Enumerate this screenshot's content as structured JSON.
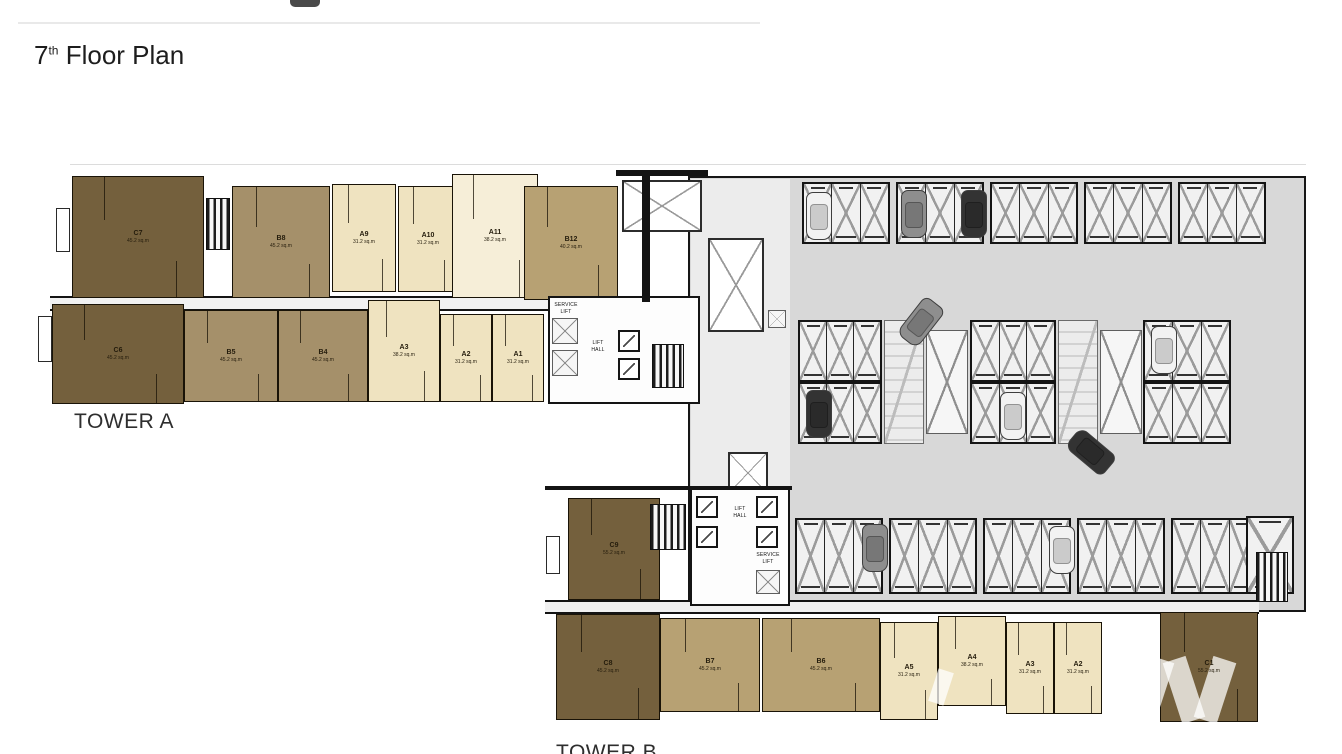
{
  "title": {
    "number": "7",
    "ordinal": "th",
    "rest": " Floor Plan"
  },
  "tower_a_label": "TOWER A",
  "tower_b_label": "TOWER B",
  "core_labels": {
    "lift_hall": "LIFT\nHALL",
    "service_lift": "SERVICE\nLIFT"
  },
  "palette": {
    "unit_dark": "#74603d",
    "unit_medium": "#a5906a",
    "unit_tan": "#b7a173",
    "unit_cream": "#efe3c0",
    "unit_cream_light": "#f6eed8",
    "parking_floor": "#d8d8d8",
    "connector_floor": "#ececec",
    "wall": "#141414",
    "stall_line": "#9b9b9b",
    "car_white": "#f2f2f2",
    "car_gray": "#8e8e8e",
    "car_dark": "#333333"
  },
  "plan": {
    "floors": [
      {
        "x": 688,
        "y": 176,
        "w": 618,
        "h": 436,
        "color": "parking_floor",
        "border": true
      },
      {
        "x": 691,
        "y": 179,
        "w": 99,
        "h": 429,
        "color": "connector_floor",
        "border": false
      }
    ],
    "corridors": [
      {
        "x": 50,
        "y": 296,
        "w": 650,
        "h": 15
      },
      {
        "x": 545,
        "y": 600,
        "w": 714,
        "h": 14
      }
    ],
    "units": [
      {
        "tower": "A",
        "id": "C7",
        "area": "45.2 sq.m",
        "palette": "unit_dark",
        "x": 72,
        "y": 176,
        "w": 132,
        "h": 122
      },
      {
        "tower": "A",
        "id": "B8",
        "area": "45.2 sq.m",
        "palette": "unit_medium",
        "x": 232,
        "y": 186,
        "w": 98,
        "h": 112
      },
      {
        "tower": "A",
        "id": "A9",
        "area": "31.2 sq.m",
        "palette": "unit_cream",
        "x": 332,
        "y": 184,
        "w": 64,
        "h": 108
      },
      {
        "tower": "A",
        "id": "A10",
        "area": "31.2 sq.m",
        "palette": "unit_cream",
        "x": 398,
        "y": 186,
        "w": 60,
        "h": 106
      },
      {
        "tower": "A",
        "id": "A11",
        "area": "38.2 sq.m",
        "palette": "unit_cream_light",
        "x": 452,
        "y": 174,
        "w": 86,
        "h": 124
      },
      {
        "tower": "A",
        "id": "B12",
        "area": "40.2 sq.m",
        "palette": "unit_tan",
        "x": 524,
        "y": 186,
        "w": 94,
        "h": 114
      },
      {
        "tower": "A",
        "id": "C6",
        "area": "45.2 sq.m",
        "palette": "unit_dark",
        "x": 52,
        "y": 304,
        "w": 132,
        "h": 100
      },
      {
        "tower": "A",
        "id": "B5",
        "area": "45.2 sq.m",
        "palette": "unit_medium",
        "x": 184,
        "y": 310,
        "w": 94,
        "h": 92
      },
      {
        "tower": "A",
        "id": "B4",
        "area": "45.2 sq.m",
        "palette": "unit_medium",
        "x": 278,
        "y": 310,
        "w": 90,
        "h": 92
      },
      {
        "tower": "A",
        "id": "A3",
        "area": "38.2 sq.m",
        "palette": "unit_cream",
        "x": 368,
        "y": 300,
        "w": 72,
        "h": 102
      },
      {
        "tower": "A",
        "id": "A2",
        "area": "31.2 sq.m",
        "palette": "unit_cream",
        "x": 440,
        "y": 314,
        "w": 52,
        "h": 88
      },
      {
        "tower": "A",
        "id": "A1",
        "area": "31.2 sq.m",
        "palette": "unit_cream",
        "x": 492,
        "y": 314,
        "w": 52,
        "h": 88
      },
      {
        "tower": "B",
        "id": "C9",
        "area": "55.2 sq.m",
        "palette": "unit_dark",
        "x": 568,
        "y": 498,
        "w": 92,
        "h": 102
      },
      {
        "tower": "B",
        "id": "C8",
        "area": "45.2 sq.m",
        "palette": "unit_dark",
        "x": 556,
        "y": 614,
        "w": 104,
        "h": 106
      },
      {
        "tower": "B",
        "id": "B7",
        "area": "45.2 sq.m",
        "palette": "unit_tan",
        "x": 660,
        "y": 618,
        "w": 100,
        "h": 94
      },
      {
        "tower": "B",
        "id": "B6",
        "area": "45.2 sq.m",
        "palette": "unit_tan",
        "x": 762,
        "y": 618,
        "w": 118,
        "h": 94
      },
      {
        "tower": "B",
        "id": "A5",
        "area": "31.2 sq.m",
        "palette": "unit_cream",
        "x": 880,
        "y": 622,
        "w": 58,
        "h": 98
      },
      {
        "tower": "B",
        "id": "A4",
        "area": "38.2 sq.m",
        "palette": "unit_cream",
        "x": 938,
        "y": 616,
        "w": 68,
        "h": 90
      },
      {
        "tower": "B",
        "id": "A3",
        "area": "31.2 sq.m",
        "palette": "unit_cream",
        "x": 1006,
        "y": 622,
        "w": 48,
        "h": 92
      },
      {
        "tower": "B",
        "id": "A2",
        "area": "31.2 sq.m",
        "palette": "unit_cream",
        "x": 1054,
        "y": 622,
        "w": 48,
        "h": 92
      },
      {
        "tower": "B",
        "id": "C1",
        "area": "55.2 sq.m",
        "palette": "unit_dark",
        "x": 1160,
        "y": 612,
        "w": 98,
        "h": 110
      }
    ],
    "stall_groups": [
      {
        "x": 802,
        "y": 182,
        "w": 88,
        "h": 62,
        "n": 3
      },
      {
        "x": 896,
        "y": 182,
        "w": 88,
        "h": 62,
        "n": 3
      },
      {
        "x": 990,
        "y": 182,
        "w": 88,
        "h": 62,
        "n": 3
      },
      {
        "x": 1084,
        "y": 182,
        "w": 88,
        "h": 62,
        "n": 3
      },
      {
        "x": 1178,
        "y": 182,
        "w": 88,
        "h": 62,
        "n": 3
      },
      {
        "x": 798,
        "y": 320,
        "w": 84,
        "h": 62,
        "n": 3
      },
      {
        "x": 970,
        "y": 320,
        "w": 86,
        "h": 62,
        "n": 3
      },
      {
        "x": 1143,
        "y": 320,
        "w": 88,
        "h": 62,
        "n": 3
      },
      {
        "x": 798,
        "y": 382,
        "w": 84,
        "h": 62,
        "n": 3
      },
      {
        "x": 970,
        "y": 382,
        "w": 86,
        "h": 62,
        "n": 3
      },
      {
        "x": 1143,
        "y": 382,
        "w": 88,
        "h": 62,
        "n": 3
      },
      {
        "x": 795,
        "y": 518,
        "w": 88,
        "h": 76,
        "n": 3
      },
      {
        "x": 889,
        "y": 518,
        "w": 88,
        "h": 76,
        "n": 3
      },
      {
        "x": 983,
        "y": 518,
        "w": 88,
        "h": 76,
        "n": 3
      },
      {
        "x": 1077,
        "y": 518,
        "w": 88,
        "h": 76,
        "n": 3
      },
      {
        "x": 1171,
        "y": 518,
        "w": 88,
        "h": 76,
        "n": 3
      },
      {
        "x": 1246,
        "y": 516,
        "w": 48,
        "h": 78,
        "n": 1
      }
    ],
    "ramps": [
      {
        "x": 884,
        "y": 320,
        "w": 40,
        "h": 124
      },
      {
        "x": 1058,
        "y": 320,
        "w": 40,
        "h": 124
      }
    ],
    "xboxes": [
      {
        "x": 926,
        "y": 330,
        "w": 42,
        "h": 104
      },
      {
        "x": 1100,
        "y": 330,
        "w": 42,
        "h": 104
      }
    ],
    "voids": [
      {
        "x": 622,
        "y": 180,
        "w": 80,
        "h": 52
      },
      {
        "x": 708,
        "y": 238,
        "w": 56,
        "h": 94
      },
      {
        "x": 728,
        "y": 452,
        "w": 40,
        "h": 42
      }
    ],
    "shafts": [
      {
        "x": 552,
        "y": 318,
        "w": 26,
        "h": 26
      },
      {
        "x": 552,
        "y": 350,
        "w": 26,
        "h": 26
      },
      {
        "x": 756,
        "y": 570,
        "w": 24,
        "h": 24
      },
      {
        "x": 768,
        "y": 310,
        "w": 18,
        "h": 18
      }
    ],
    "cores": [
      {
        "name": "core-tower-a",
        "x": 548,
        "y": 296,
        "w": 152,
        "h": 108
      },
      {
        "name": "core-tower-b",
        "x": 690,
        "y": 488,
        "w": 100,
        "h": 118
      }
    ],
    "lifts": [
      {
        "x": 618,
        "y": 330
      },
      {
        "x": 618,
        "y": 358
      },
      {
        "x": 696,
        "y": 496
      },
      {
        "x": 696,
        "y": 526
      },
      {
        "x": 756,
        "y": 496
      },
      {
        "x": 756,
        "y": 526
      }
    ],
    "core_texts": [
      {
        "x": 544,
        "y": 302,
        "w": 44,
        "key": "service_lift"
      },
      {
        "x": 580,
        "y": 340,
        "w": 36,
        "key": "lift_hall"
      },
      {
        "x": 722,
        "y": 506,
        "w": 36,
        "key": "lift_hall"
      },
      {
        "x": 746,
        "y": 552,
        "w": 44,
        "key": "service_lift"
      }
    ],
    "stairs": [
      {
        "x": 206,
        "y": 198,
        "w": 24,
        "h": 52
      },
      {
        "x": 652,
        "y": 344,
        "w": 32,
        "h": 44
      },
      {
        "x": 650,
        "y": 504,
        "w": 36,
        "h": 46
      },
      {
        "x": 1256,
        "y": 552,
        "w": 32,
        "h": 50
      }
    ],
    "balconies": [
      {
        "x": 56,
        "y": 208,
        "w": 14,
        "h": 44
      },
      {
        "x": 38,
        "y": 316,
        "w": 14,
        "h": 46
      },
      {
        "x": 546,
        "y": 536,
        "w": 14,
        "h": 38
      }
    ],
    "walls": [
      {
        "x": 642,
        "y": 176,
        "w": 8,
        "h": 126
      },
      {
        "x": 616,
        "y": 170,
        "w": 92,
        "h": 6
      },
      {
        "x": 545,
        "y": 486,
        "w": 247,
        "h": 4
      }
    ],
    "cars": [
      {
        "x": 806,
        "y": 192,
        "rot": 0,
        "c": "car_white"
      },
      {
        "x": 901,
        "y": 190,
        "rot": 0,
        "c": "car_gray"
      },
      {
        "x": 961,
        "y": 190,
        "rot": 0,
        "c": "car_dark"
      },
      {
        "x": 908,
        "y": 298,
        "rot": 38,
        "c": "car_gray"
      },
      {
        "x": 806,
        "y": 390,
        "rot": 0,
        "c": "car_dark"
      },
      {
        "x": 1000,
        "y": 392,
        "rot": 0,
        "c": "car_white"
      },
      {
        "x": 1151,
        "y": 326,
        "rot": 0,
        "c": "car_white"
      },
      {
        "x": 1078,
        "y": 428,
        "rot": 130,
        "c": "car_dark"
      },
      {
        "x": 862,
        "y": 524,
        "rot": 0,
        "c": "car_gray"
      },
      {
        "x": 1049,
        "y": 526,
        "rot": 0,
        "c": "car_white"
      }
    ],
    "watermark": [
      {
        "x": 1141,
        "y": 658,
        "w": 24,
        "h": 64,
        "rot": 18
      },
      {
        "x": 1172,
        "y": 658,
        "w": 24,
        "h": 64,
        "rot": -18
      },
      {
        "x": 1203,
        "y": 658,
        "w": 24,
        "h": 64,
        "rot": 18
      },
      {
        "x": 933,
        "y": 670,
        "w": 16,
        "h": 34,
        "rot": 18
      }
    ]
  }
}
